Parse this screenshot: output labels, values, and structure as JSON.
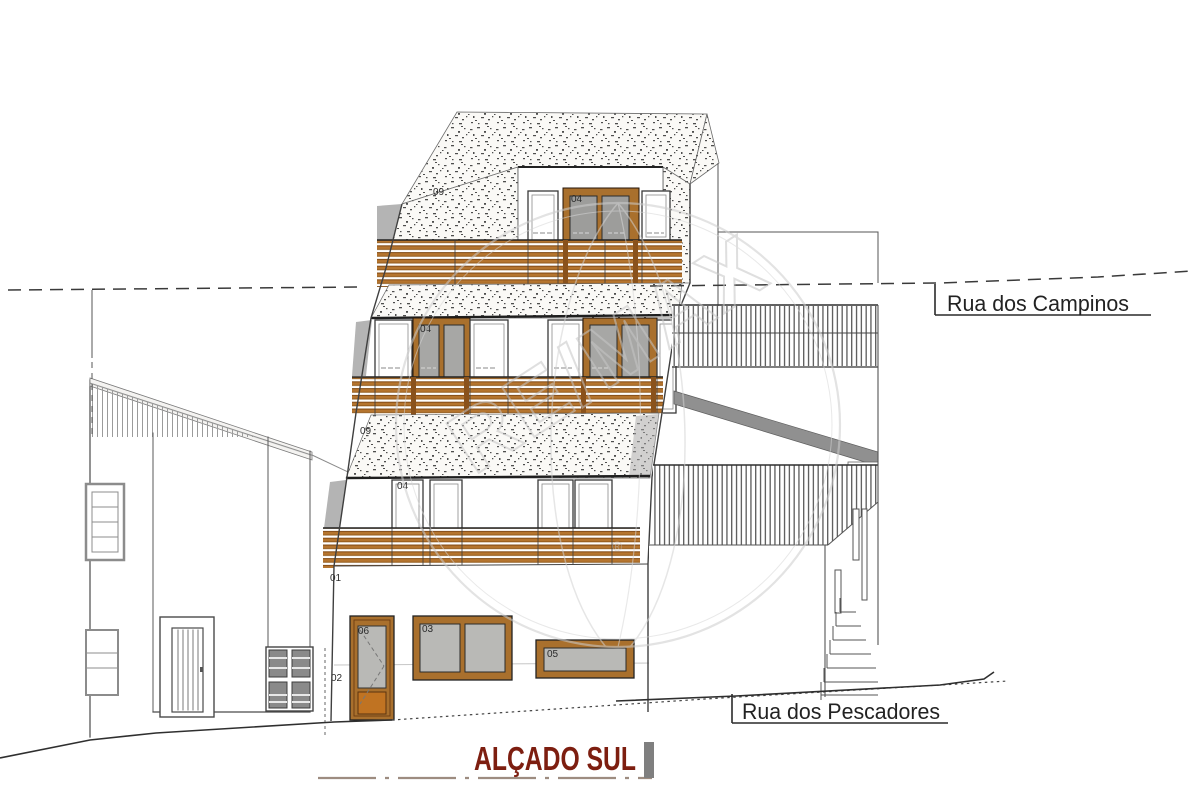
{
  "title": {
    "text": "ALÇADO SUL"
  },
  "streets": {
    "campinos": "Rua dos Campinos",
    "pescadores": "Rua dos Pescadores"
  },
  "labels": {
    "roof_09": "09",
    "band_09": "09",
    "dormer_04": "04",
    "floor2_04": "04",
    "floor1_04": "04",
    "wall_01": "01",
    "wall_02": "02",
    "win_03": "03",
    "win_05": "05",
    "door_06": "06"
  },
  "watermark": {
    "brand": "RE/MAX",
    "reg": "®"
  },
  "colors": {
    "wood_slat": "#b5752f",
    "frame_brown": "#a9702d",
    "door_panel_orange": "#c07322",
    "glass_gray": "#b9b9b6",
    "ramp_gray": "#909090",
    "title_red": "#7d1e10",
    "watermark_gray": "#c6c6c6"
  }
}
